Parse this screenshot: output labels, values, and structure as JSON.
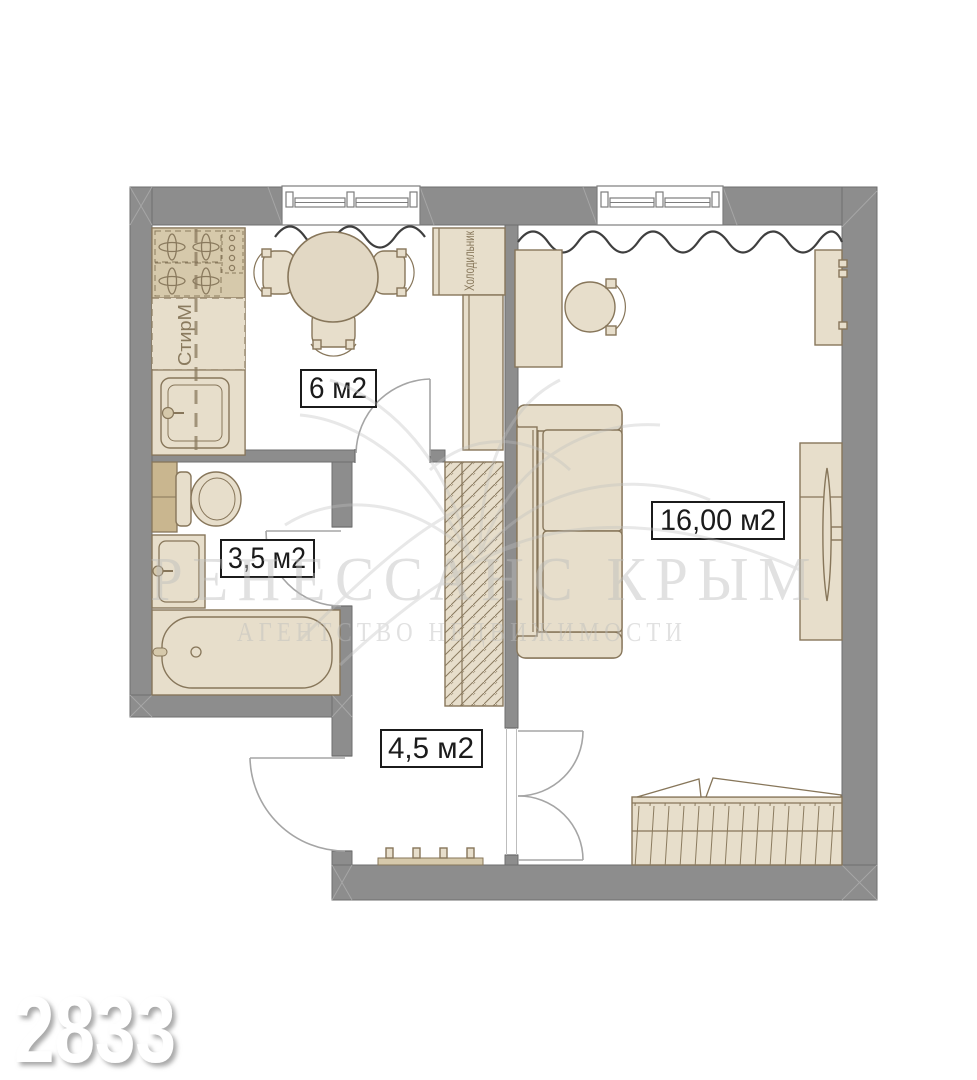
{
  "floorplan": {
    "rooms": [
      {
        "id": "kitchen",
        "area_label": "6 м2"
      },
      {
        "id": "bathroom",
        "area_label": "3,5 м2"
      },
      {
        "id": "hallway",
        "area_label": "4,5 м2"
      },
      {
        "id": "living_room",
        "area_label": "16,00 м2"
      }
    ],
    "appliance_labels": {
      "washing_machine": "СтирМ",
      "fridge": "Холодильник"
    },
    "icons": [
      "stove-icon",
      "washing-machine-icon",
      "kitchen-sink-icon",
      "dining-table-icon",
      "fridge-icon",
      "wardrobe-icon",
      "toilet-icon",
      "bathroom-sink-icon",
      "bathtub-icon",
      "coat-hooks-icon",
      "desk-icon",
      "chair-icon",
      "sofa-icon",
      "tv-cabinet-icon",
      "shelf-icon",
      "bed-icon",
      "window-icon",
      "door-icon",
      "curtain-icon"
    ],
    "colors": {
      "wall": "#8d8d8d",
      "wall_outline": "#6e6e6e",
      "furniture_fill": "#e7decb",
      "furniture_stroke": "#87765a",
      "hob_fill": "#d6c9ab",
      "label_text": "#1b1b1b",
      "appliance_label_text": "#8a7a5e",
      "watermark": "#bdbdbd"
    }
  },
  "watermark": {
    "agency_name": "РЕНЕССАНС КРЫМ",
    "agency_tagline": "АГЕНТСТВО НЕДВИЖИМОСТИ"
  },
  "listing_number": "2833"
}
